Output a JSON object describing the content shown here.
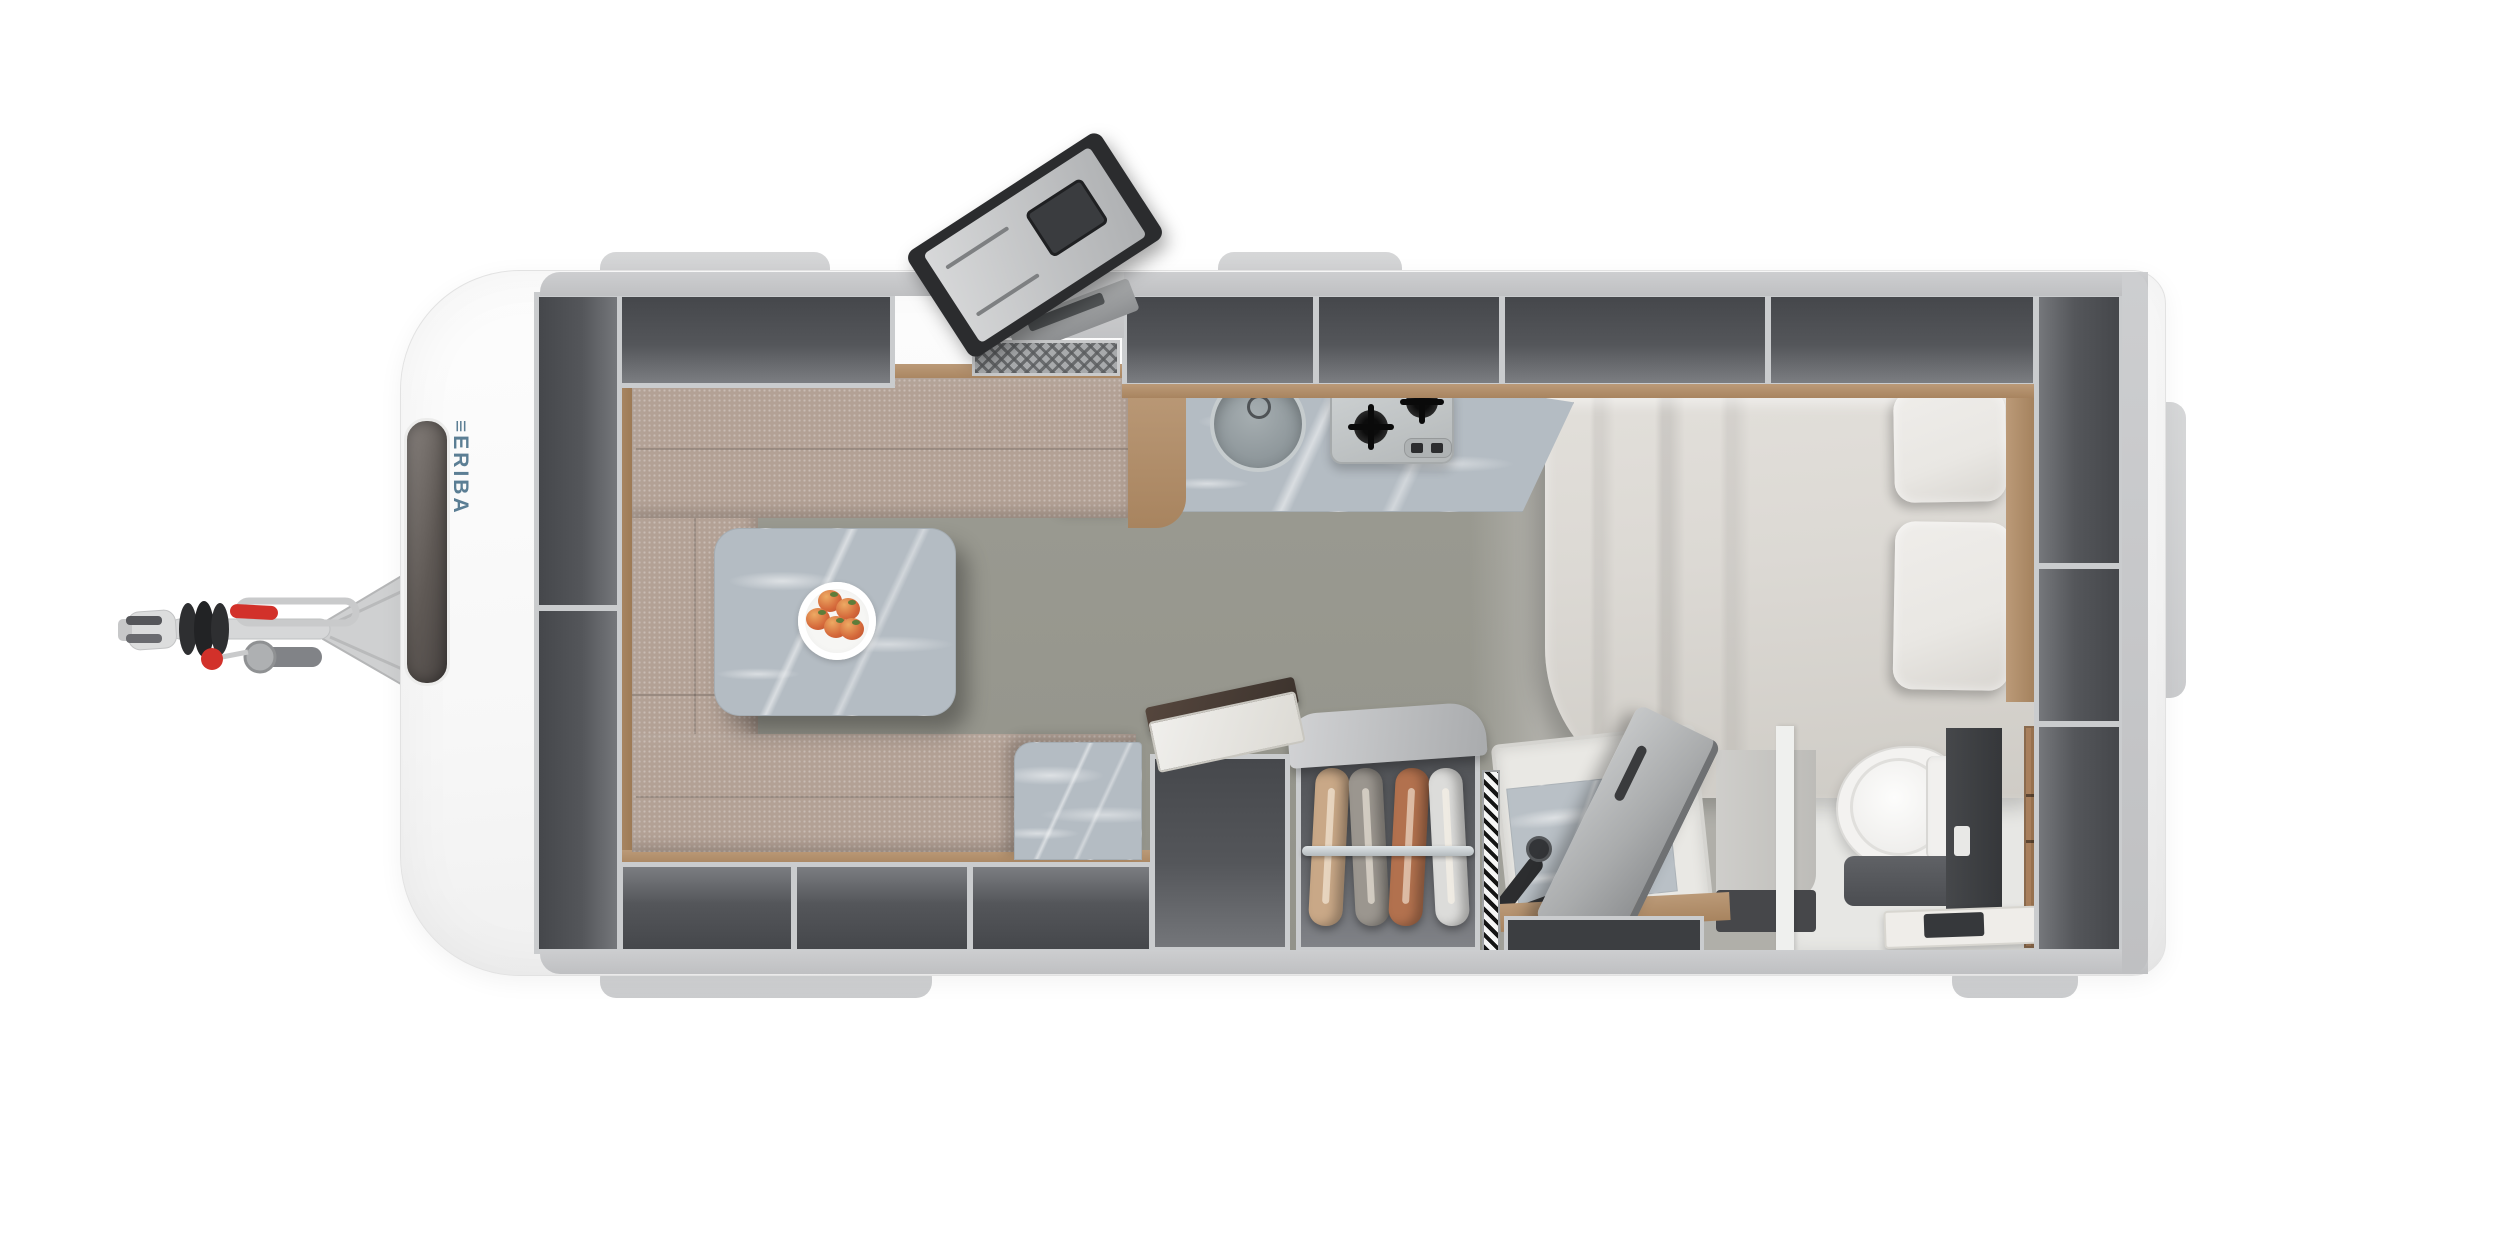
{
  "brand": {
    "logo_mark": "≡",
    "logo_text": "ERIBA"
  },
  "scene": {
    "view": "top-down caravan floor plan",
    "plate_fruit_count": 5,
    "hob_burner_count": 2,
    "wardrobe_garment_count": 4
  },
  "wardrobe": {
    "garment_colors": [
      "#c9a887",
      "#9b968f",
      "#b2714e",
      "#dcdcda"
    ]
  },
  "colors": {
    "body-white": "#fbfbfb",
    "tab-gray": "#d6d7d8",
    "wall-gray": "#c7c8c9",
    "locker-dark": "#54565a",
    "divider-light": "#caccce",
    "wood": "#b3916f",
    "fabric-taupe": "#b3a195",
    "marble-base": "#b4bcc3",
    "floor-green-gray": "#98988f",
    "floor-bed-area": "#b0afa9",
    "bathroom-floor": "#e7e7e4",
    "bed-linen": "#dcd9d4",
    "pillow": "#e9e7e3",
    "logo-blue": "#5b7e94",
    "accent-red": "#d2312a",
    "door-frame-dark": "#2b2c2e"
  }
}
